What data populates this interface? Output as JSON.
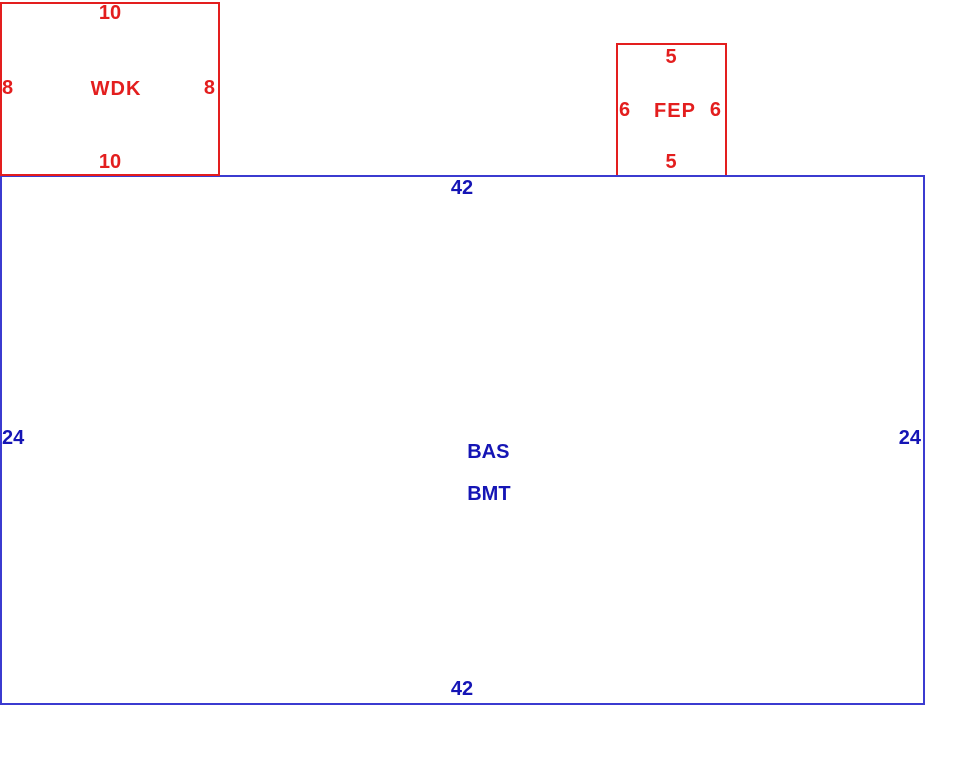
{
  "sketch": {
    "areas": {
      "wdk": {
        "label": "WDK",
        "dim_top": "10",
        "dim_bottom": "10",
        "dim_left": "8",
        "dim_right": "8"
      },
      "fep": {
        "label": "FEP",
        "dim_top": "5",
        "dim_bottom": "5",
        "dim_left": "6",
        "dim_right": "6"
      },
      "bas": {
        "label_line1": "BAS",
        "label_line2": "BMT",
        "dim_top": "42",
        "dim_bottom": "42",
        "dim_left": "24",
        "dim_right": "24"
      }
    }
  },
  "colors": {
    "red": "#e31e1e",
    "blue_line": "#3b3bd0",
    "blue_text": "#1515b5",
    "background": "#ffffff"
  }
}
